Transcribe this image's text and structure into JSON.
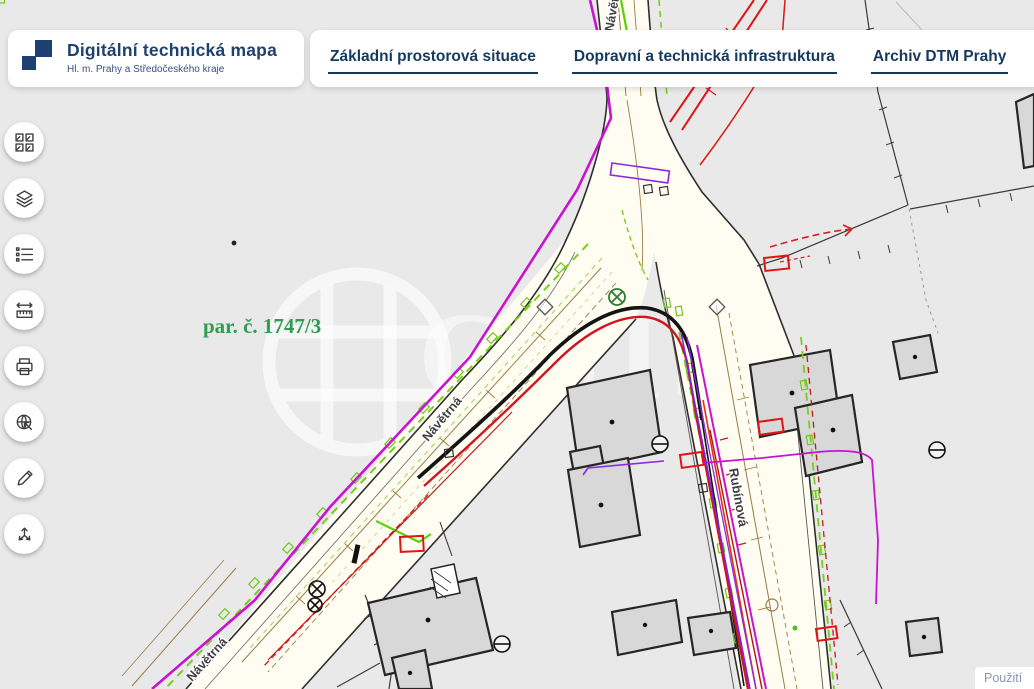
{
  "header": {
    "brand": {
      "title": "Digitální technická mapa",
      "subtitle": "Hl. m. Prahy a Středočeského kraje"
    },
    "tabs": [
      {
        "label": "Základní prostorová situace"
      },
      {
        "label": "Dopravní a technická infrastruktura"
      },
      {
        "label": "Archiv DTM Prahy"
      }
    ]
  },
  "toolbar": {
    "buttons": [
      {
        "name": "basemap-gallery",
        "icon": "grid-squares-icon"
      },
      {
        "name": "layers",
        "icon": "layers-icon"
      },
      {
        "name": "legend",
        "icon": "list-icon"
      },
      {
        "name": "measure",
        "icon": "ruler-arrows-icon"
      },
      {
        "name": "print",
        "icon": "printer-icon"
      },
      {
        "name": "locate",
        "icon": "globe-arrow-icon"
      },
      {
        "name": "draw",
        "icon": "pencil-icon"
      },
      {
        "name": "share",
        "icon": "three-arrows-icon"
      }
    ]
  },
  "map": {
    "parcel_label": "par. č. 1747/3",
    "streets": {
      "navetrna": "Návětrná",
      "rubinova": "Rubínová"
    },
    "watermark": {
      "letters": "CUIŠ"
    },
    "attribution": "Použití",
    "colors": {
      "background": "#e9e9e9",
      "road_fill": "#fffdf2",
      "building_fill": "#d8d8d8",
      "magenta": "#c913cf",
      "red": "#dd1515",
      "green": "#77cf1b",
      "violet": "#7d22e0",
      "brown": "#9a7c44",
      "parcel_green": "#2f9e52",
      "navy": "#1d3f72"
    }
  }
}
